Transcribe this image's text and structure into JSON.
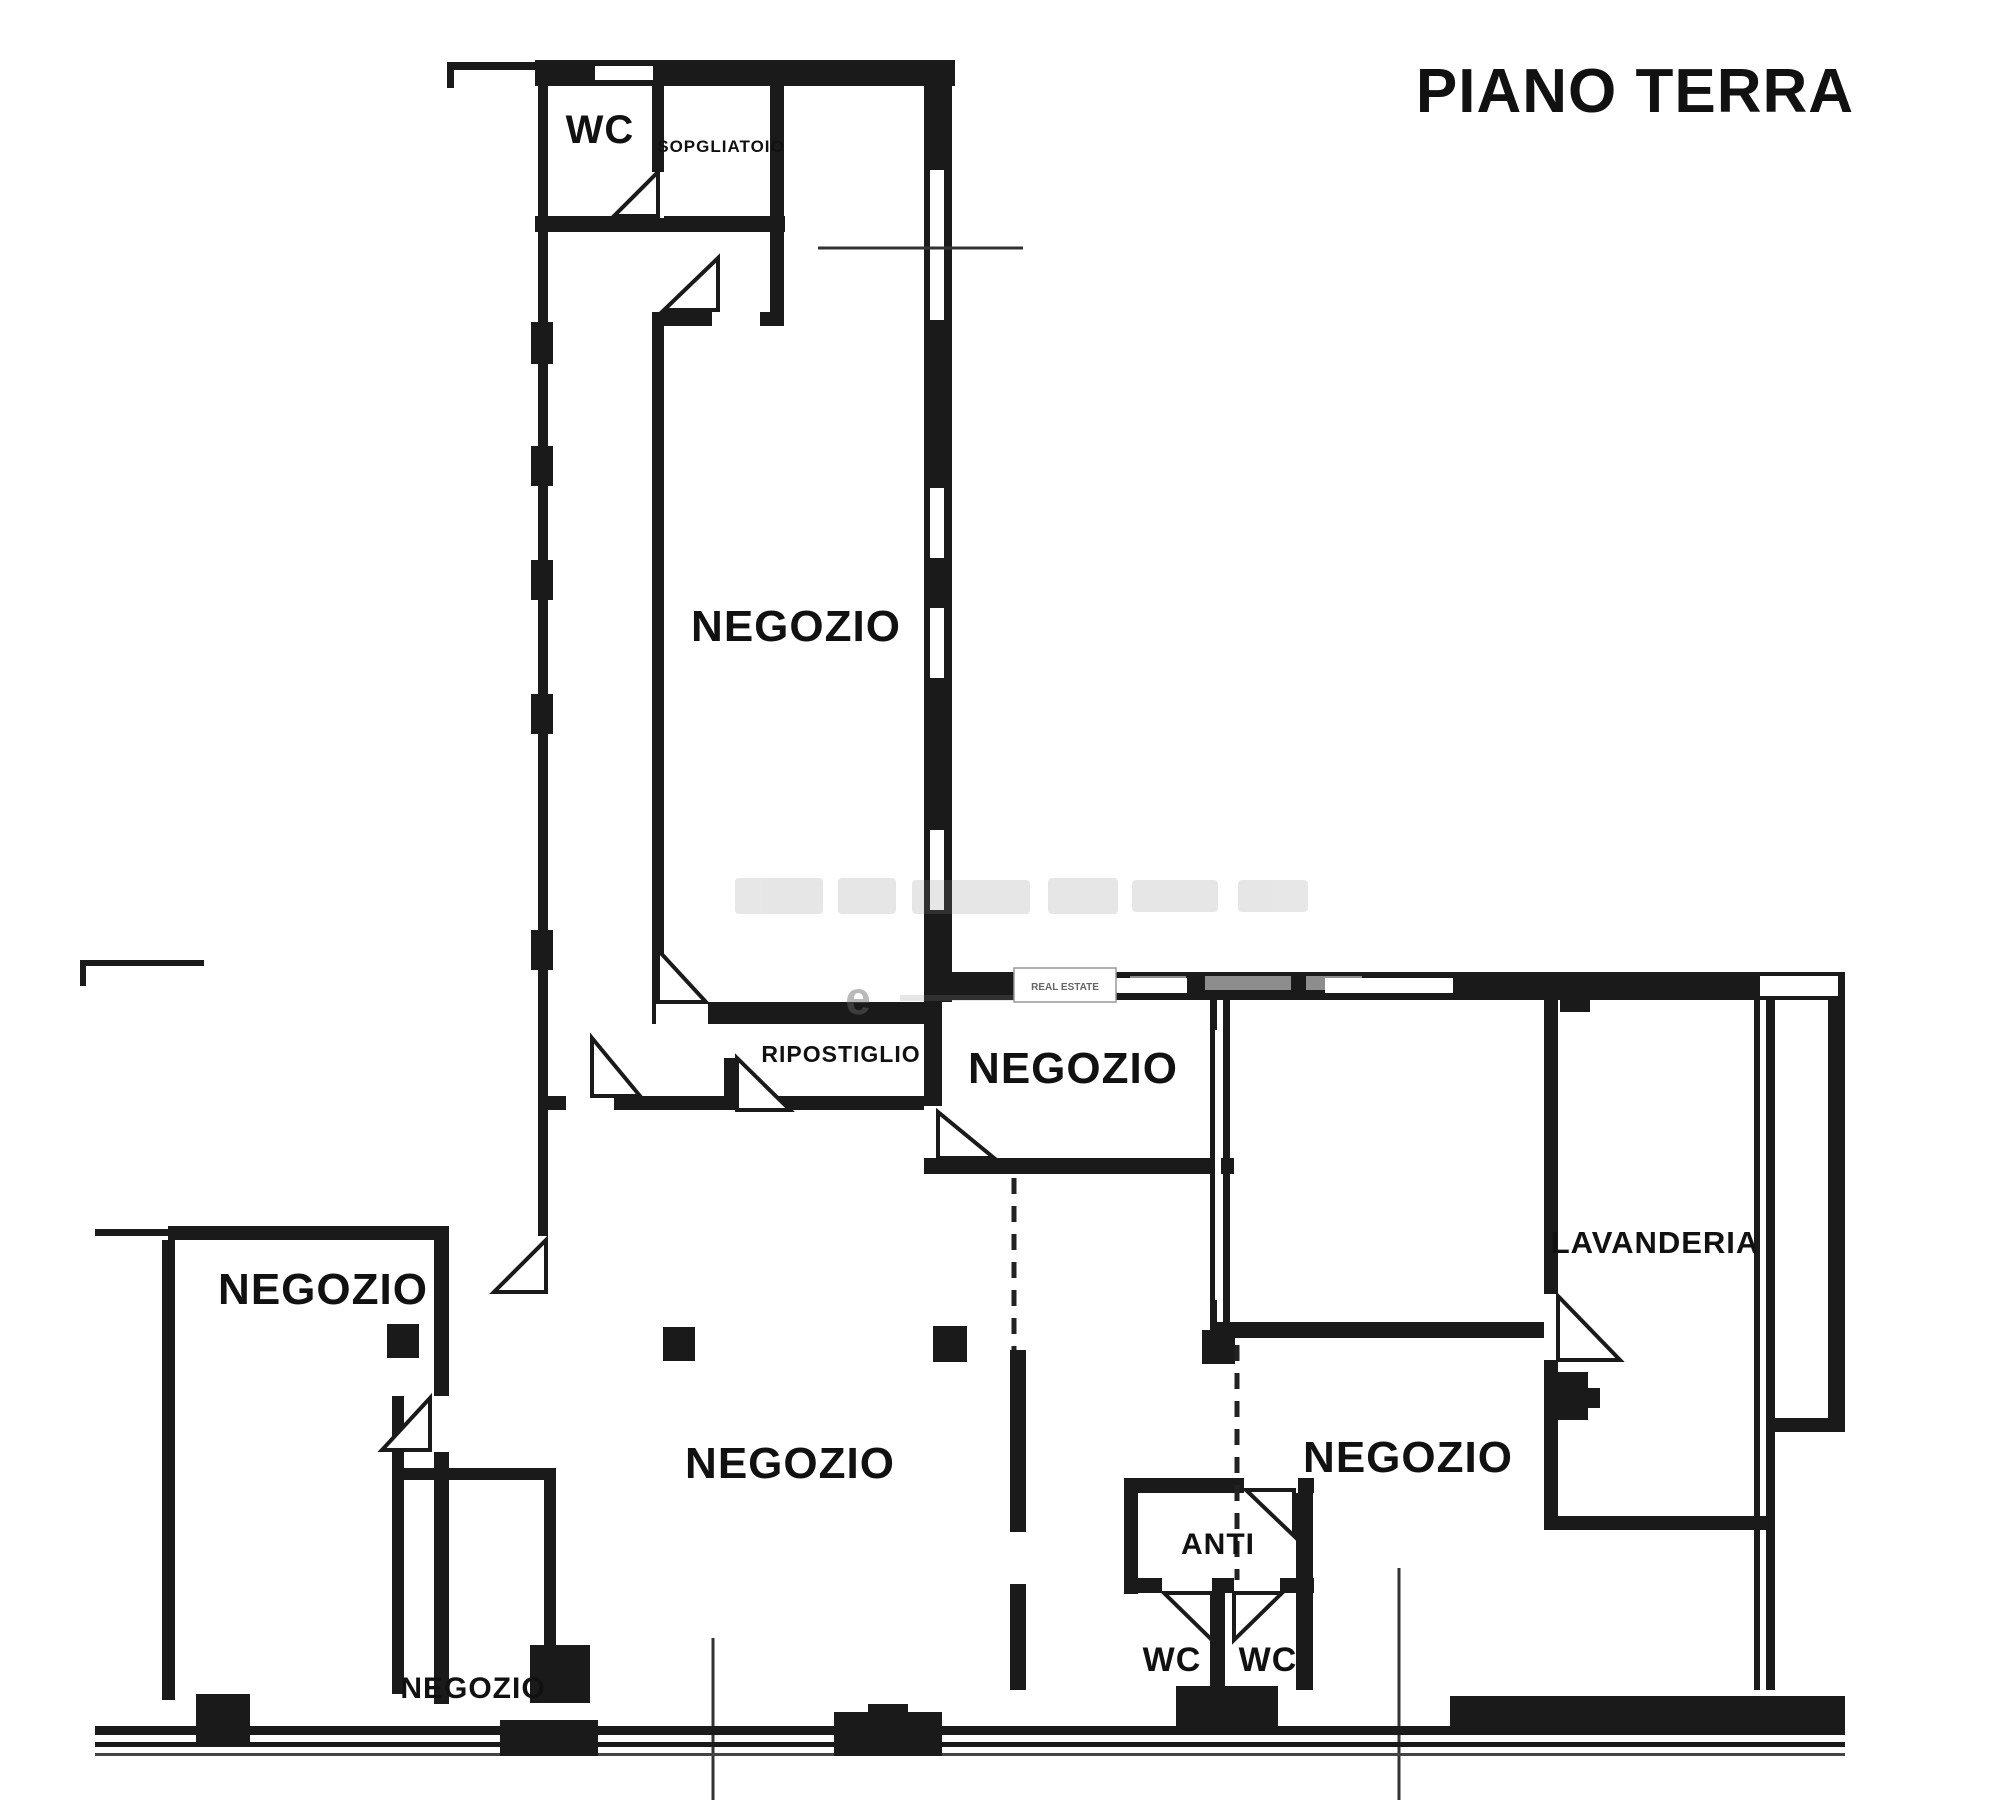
{
  "title": "PIANO TERRA",
  "rooms": {
    "wc_top": "WC",
    "sopgliatoio": "SOPGLIATOIO",
    "negozio_tall": "NEGOZIO",
    "ripostiglio": "RIPOSTIGLIO",
    "negozio_upper_right": "NEGOZIO",
    "lavanderia": "LAVANDERIA",
    "negozio_left": "NEGOZIO",
    "negozio_center": "NEGOZIO",
    "negozio_right": "NEGOZIO",
    "negozio_small": "NEGOZIO",
    "anti": "ANTI",
    "wc_left": "WC",
    "wc_right": "WC"
  },
  "watermark": {
    "box_text": "REAL ESTATE"
  },
  "colors": {
    "wall": "#1a1a1a",
    "background": "#ffffff",
    "watermark_gray": "#888888"
  }
}
